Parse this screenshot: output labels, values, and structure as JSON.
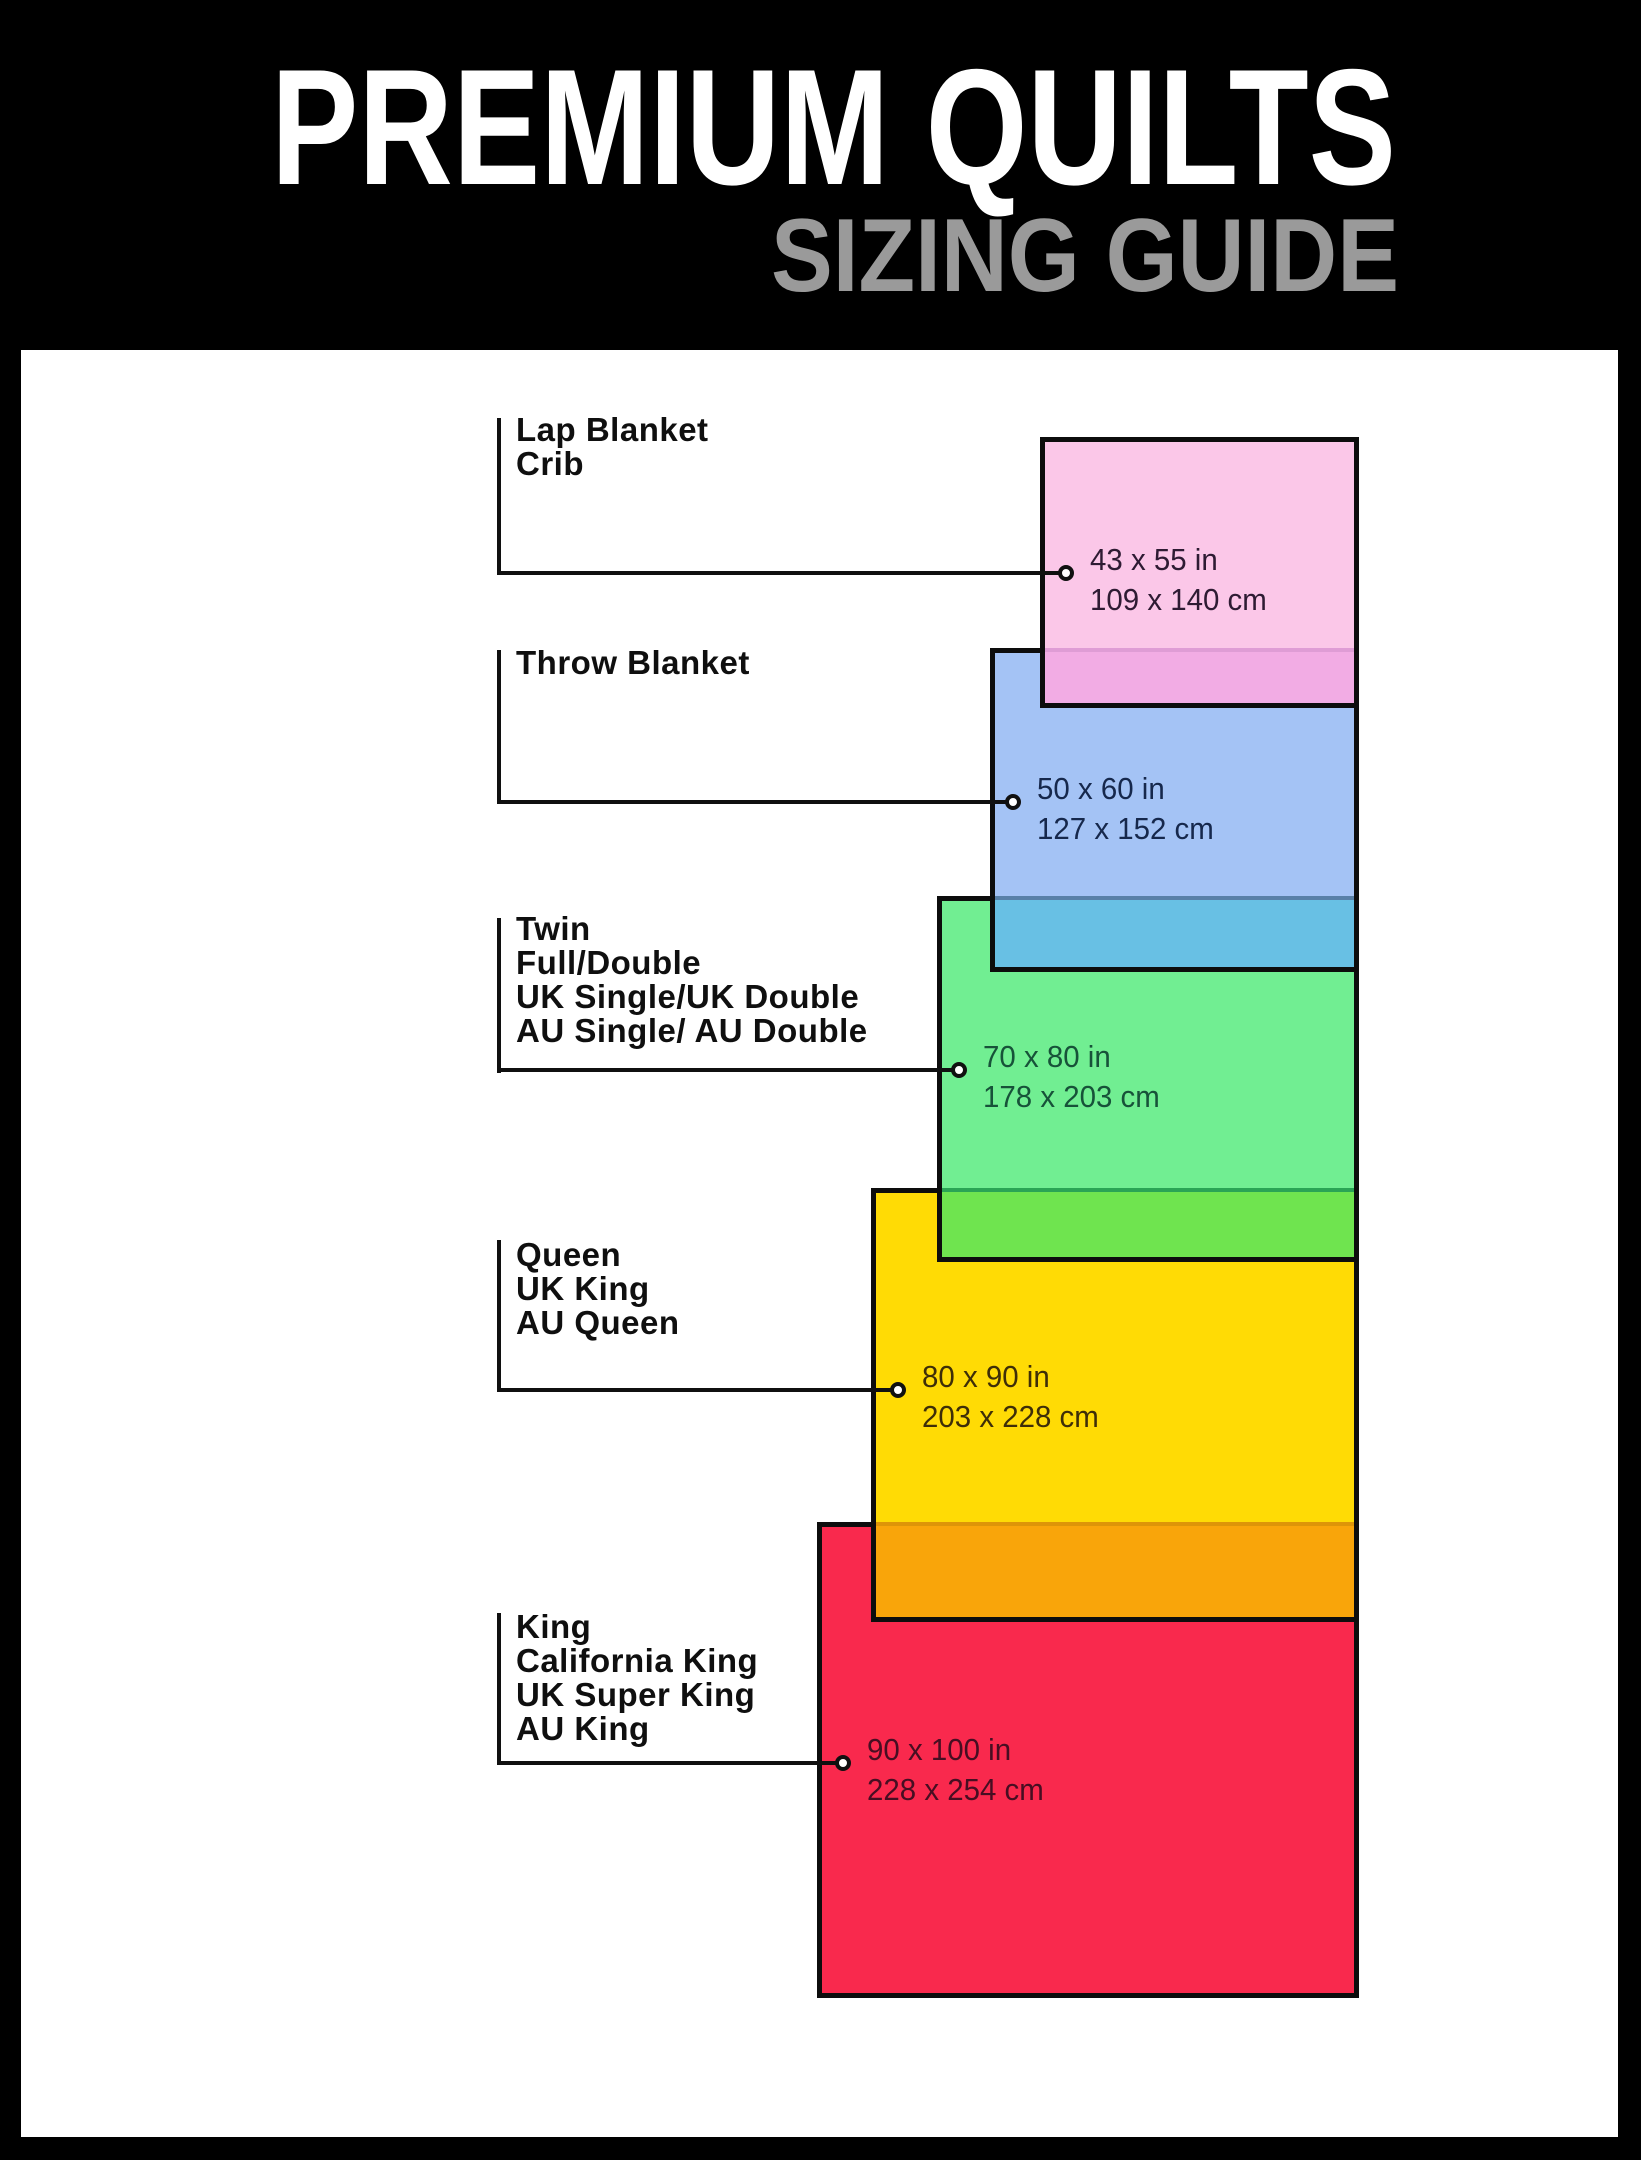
{
  "header": {
    "title": "PREMIUM QUILTS",
    "subtitle": "SIZING GUIDE"
  },
  "colors": {
    "page_bg": "#000000",
    "panel_bg": "#ffffff",
    "title_text": "#ffffff",
    "subtitle_text": "#9a9a9a",
    "callout_line": "#101010",
    "rect_border": "#0d0d0d",
    "label_text": "#0f0f0f"
  },
  "sizes": [
    {
      "name": "lap-blanket-crib",
      "labels": [
        "Lap Blanket",
        "Crib"
      ],
      "size_in": "43 x 55 in",
      "size_cm": "109 x 140 cm",
      "fill": "#FBC7E8",
      "overlap_fill": "#F2ACE4",
      "overlap_line": "#DF9CD5",
      "dims_text_color": "#2E1B33"
    },
    {
      "name": "throw-blanket",
      "labels": [
        "Throw Blanket"
      ],
      "size_in": "50 x 60 in",
      "size_cm": "127 x 152 cm",
      "fill": "#A4C3F5",
      "overlap_fill": "#68C0E4",
      "overlap_line": "#5880A8",
      "dims_text_color": "#16284C"
    },
    {
      "name": "twin-full-double",
      "labels": [
        "Twin",
        "Full/Double",
        "UK Single/UK Double",
        "AU Single/ AU Double"
      ],
      "size_in": "70 x 80 in",
      "size_cm": "178 x 203 cm",
      "fill": "#71EE92",
      "overlap_fill": "#6FE44F",
      "overlap_line": "#2AA455",
      "dims_text_color": "#175239"
    },
    {
      "name": "queen-uk-king-au-queen",
      "labels": [
        "Queen",
        "UK King",
        "AU Queen"
      ],
      "size_in": "80 x 90 in",
      "size_cm": "203 x 228 cm",
      "fill": "#FFDB05",
      "overlap_fill": "#F9A50A",
      "overlap_line": "#DE9508",
      "dims_text_color": "#3E2E08"
    },
    {
      "name": "king-california-king",
      "labels": [
        "King",
        "California King",
        "UK Super King",
        "AU King"
      ],
      "size_in": "90 x 100 in",
      "size_cm": "228 x 254 cm",
      "fill": "#F9294D",
      "overlap_fill": "",
      "overlap_line": "",
      "dims_text_color": "#470E22"
    }
  ]
}
